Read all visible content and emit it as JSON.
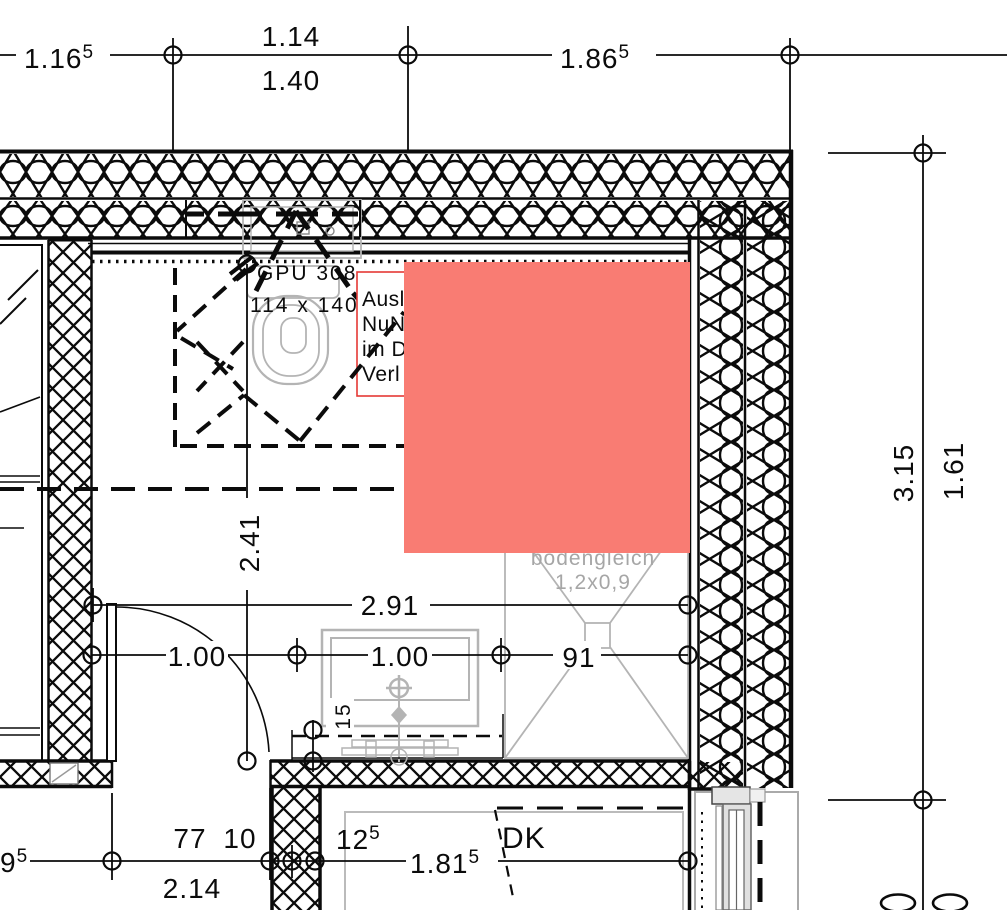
{
  "colors": {
    "line": "#0b0b0b",
    "fixture_gray": "#b4b4b4",
    "text_gray": "#a6a6a6",
    "highlight": "#f97c73",
    "annotation_border": "#e53935"
  },
  "dim_top": {
    "left_v": "1.16",
    "left_s": "5",
    "mid_above": "1.14",
    "mid_below": "1.40",
    "right_v": "1.86",
    "right_s": "5"
  },
  "dim_right": {
    "outer": "3.15",
    "inner": "1.61",
    "zero_left": "0",
    "zero_right": "0"
  },
  "dim_mid": {
    "width": "2.91",
    "seg_left": "1.00",
    "seg_center": "1.00",
    "seg_right": "91",
    "depth": "2.41",
    "vanity": "15"
  },
  "dim_bottom": {
    "left_cut_v": "9",
    "left_cut_s": "5",
    "a": "77",
    "b": "10",
    "total": "2.14",
    "pier_v": "12",
    "pier_s": "5",
    "dk_v": "1.81",
    "dk_s": "5"
  },
  "labels": {
    "window_code": "GPU 308",
    "window_size": "114 x 140",
    "note1": "Ausl",
    "note2": "NuN",
    "note3": "im D",
    "note4": "Verl",
    "shower1": "bodengleich",
    "shower2": "1,2x0,9",
    "dk": "DK"
  }
}
